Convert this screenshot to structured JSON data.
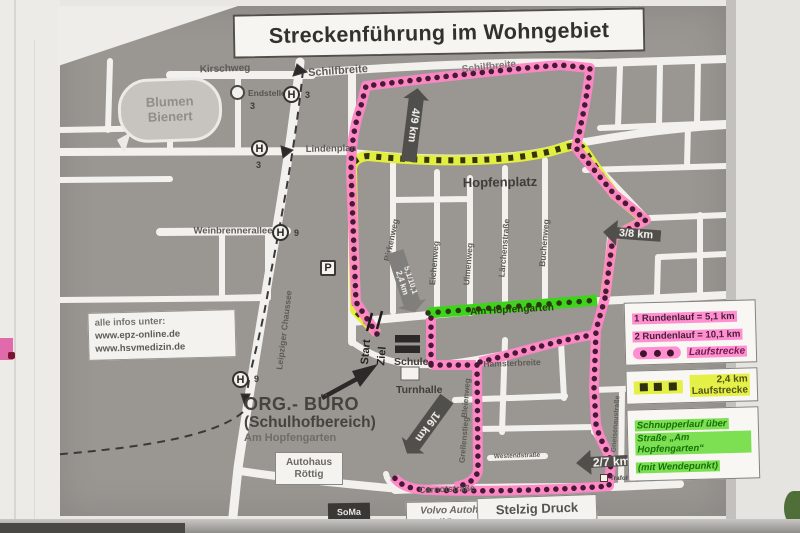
{
  "title": {
    "text": "Streckenführung im Wohngebiet"
  },
  "info_box": {
    "lines": [
      "alle infos unter:",
      "www.epz-online.de",
      "www.hsvmedizin.de"
    ]
  },
  "org_buero": {
    "lines": [
      "ORG.- BÜRO",
      "(Schulhofbereich)",
      "Am Hopfengarten"
    ]
  },
  "start_finish": {
    "start": "Start",
    "ziel": "Ziel"
  },
  "buildings": {
    "schule": "Schule",
    "turnhalle": "Turnhalle",
    "autohaus_line1": "Autohaus",
    "autohaus_line2": "Röttig",
    "volvo_line1": "Volvo Autohaus",
    "volvo_line2": "Wolf Zagermann",
    "stelzig": "Stelzig Druck",
    "soma": "SoMa",
    "trafohaus": "Trafohaus",
    "blumen_line1": "Blumen",
    "blumen_line2": "Bienert"
  },
  "transit": {
    "stop_letter": "H",
    "line_3": "3",
    "line_9": "9",
    "endstelle": "Endstelle",
    "endstelle_line": "3",
    "parking": "P"
  },
  "km_markers": {
    "m49": "4/9 km",
    "m38": "3/8 km",
    "m16": "1/6 km",
    "m27": "2/7 km",
    "m51_line1": "5,1/10,1",
    "m51_line2": "2,4 km"
  },
  "legend": {
    "pink": {
      "line1": "1 Rundenlauf = 5,1 km",
      "line2": "2 Rundenlauf = 10,1 km",
      "label": "Laufstrecke",
      "color": "#ff8fd0"
    },
    "yellow": {
      "line1": "2,4 km",
      "line2": "Laufstrecke",
      "color": "#e4f046"
    },
    "green": {
      "lines": [
        "Schnupperlauf über",
        "Straße „Am Hopfengarten“",
        "(mit Wendepunkt)"
      ],
      "color": "#3ed41c"
    }
  },
  "colors": {
    "route_pink": "#ff86c6",
    "route_dots": "#471a33",
    "route_yellow": "#e2ef3e",
    "route_green": "#3ed41c",
    "map_gray": "#9a9793",
    "street_white": "#f3f1ee"
  },
  "streets": [
    {
      "id": "kirschweg",
      "text": "Kirschweg",
      "x": 225,
      "y": 69,
      "r": -2,
      "s": 10
    },
    {
      "id": "schilfbreite-west",
      "text": "Schilfbreite",
      "x": 338,
      "y": 71,
      "r": -4,
      "s": 11
    },
    {
      "id": "schilfbreite-east",
      "text": "Schilfbreite",
      "x": 489,
      "y": 67,
      "r": -6,
      "s": 10,
      "c": "#7c7a75"
    },
    {
      "id": "lindenplan",
      "text": "Lindenplan",
      "x": 331,
      "y": 149,
      "r": -1,
      "s": 9.5
    },
    {
      "id": "hopfenplatz",
      "text": "Hopfenplatz",
      "x": 500,
      "y": 182,
      "r": -1,
      "s": 13,
      "c": "#3f3d39"
    },
    {
      "id": "weinbrennerallee",
      "text": "Weinbrennerallee",
      "x": 233,
      "y": 231,
      "r": 0,
      "s": 9.5
    },
    {
      "id": "leipziger-chaussee",
      "text": "Leipziger Chaussee",
      "x": 284,
      "y": 330,
      "r": -83,
      "s": 8.5
    },
    {
      "id": "birkenweg",
      "text": "Birkenweg",
      "x": 391,
      "y": 240,
      "r": -78,
      "s": 8.5
    },
    {
      "id": "eichenweg",
      "text": "Eichenweg",
      "x": 434,
      "y": 263,
      "r": -85,
      "s": 8.5
    },
    {
      "id": "ulmenweg",
      "text": "Ulmenweg",
      "x": 468,
      "y": 264,
      "r": -85,
      "s": 8.5
    },
    {
      "id": "laerchenstrasse",
      "text": "Lärchenstraße",
      "x": 504,
      "y": 248,
      "r": -85,
      "s": 8.5
    },
    {
      "id": "buchenweg",
      "text": "Buchenweg",
      "x": 544,
      "y": 243,
      "r": -85,
      "s": 8.5
    },
    {
      "id": "am-hopfengarten",
      "text": "Am Hopfengarten",
      "x": 512,
      "y": 310,
      "r": -3,
      "s": 10,
      "c": "#2c3a12"
    },
    {
      "id": "bleienweg",
      "text": "Bleienweg",
      "x": 466,
      "y": 398,
      "r": -85,
      "s": 8
    },
    {
      "id": "grellenstieg",
      "text": "Grellenstieg",
      "x": 464,
      "y": 440,
      "r": -85,
      "s": 8
    },
    {
      "id": "hamsterbreite",
      "text": "Hamsterbreite",
      "x": 512,
      "y": 363,
      "r": -2,
      "s": 8.5
    },
    {
      "id": "westendstrasse",
      "text": "Westendstraße",
      "x": 517,
      "y": 456,
      "r": -2,
      "s": 6.5
    },
    {
      "id": "gneisenaustrasse",
      "text": "Gneisenaustraße",
      "x": 616,
      "y": 424,
      "r": -86,
      "s": 7
    },
    {
      "id": "carnotstrasse",
      "text": "Carnotstraße",
      "x": 447,
      "y": 489,
      "r": -2,
      "s": 9
    }
  ]
}
